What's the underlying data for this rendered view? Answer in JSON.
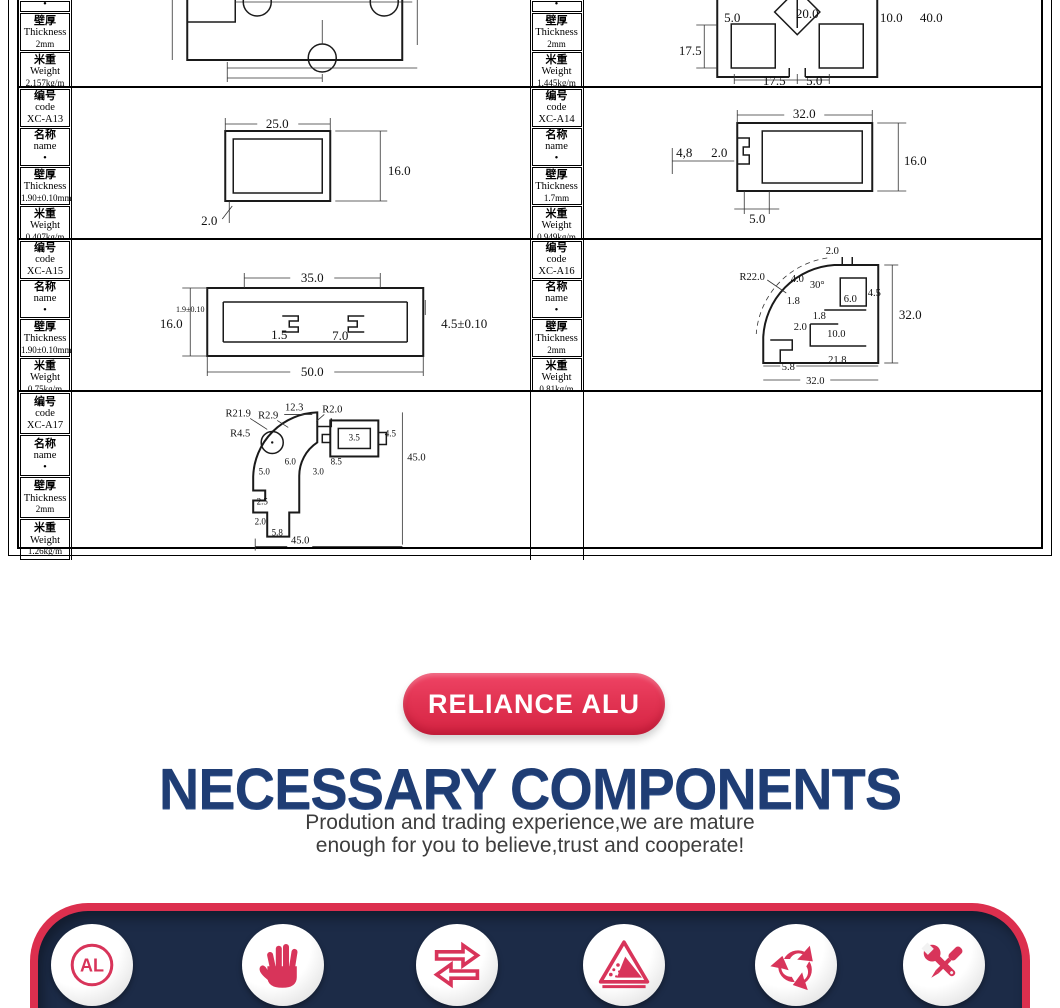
{
  "colors": {
    "crimson": "#d8345a",
    "navy": "#1c2b47",
    "red_border": "#dc2f4e",
    "heading_blue": "#1f3d74"
  },
  "table": {
    "header_labels": {
      "code_zh": "编号",
      "code_en": "code",
      "name_zh": "名称",
      "name_en": "name",
      "name_value": "•",
      "thk_zh": "壁厚",
      "thk_en": "Thickness",
      "wt_zh": "米重",
      "wt_en": "Weight"
    },
    "profiles": {
      "r1l": {
        "thickness": "2mm",
        "weight": "2.157kg/m"
      },
      "r1r": {
        "thickness": "2mm",
        "weight": "1.445kg/m",
        "dims": {
          "d1": "5.0",
          "d2": "20.0",
          "d3": "10.0",
          "d4": "40.0",
          "d5": "17.5",
          "d6": "17.5",
          "d7": "5.0"
        }
      },
      "a13": {
        "code": "XC-A13",
        "thickness": "1.90±0.10mm",
        "weight": "0.407kg/m",
        "dims": {
          "w": "25.0",
          "h": "16.0",
          "t": "2.0"
        }
      },
      "a14": {
        "code": "XC-A14",
        "thickness": "1.7mm",
        "weight": "0.949kg/m",
        "dims": {
          "w": "32.0",
          "h": "16.0",
          "g": "4,8",
          "t": "2.0",
          "b": "5.0"
        }
      },
      "a15": {
        "code": "XC-A15",
        "thickness": "1.90±0.10mm",
        "weight": "0.75kg/m",
        "dims": {
          "t": "35.0",
          "h": "16.0",
          "b": "50.0",
          "c1": "1.5",
          "c2": "7.0",
          "r": "4.5±0.10",
          "l": "1.9±0.10"
        }
      },
      "a16": {
        "code": "XC-A16",
        "thickness": "2mm",
        "weight": "0.81kg/m",
        "dims": {
          "r": "R22.0",
          "d1": "4.0",
          "a": "30°",
          "d2": "2.0",
          "d3": "4.5",
          "d4": "6.0",
          "d5": "1.8",
          "d6": "1.8",
          "d7": "2.0",
          "d8": "10.0",
          "h": "32.0",
          "b1": "5.8",
          "b2": "21.8",
          "w": "32.0"
        }
      },
      "a17": {
        "code": "XC-A17",
        "thickness": "2mm",
        "weight": "1.26kg/m",
        "dims": {
          "r1": "R21.9",
          "r2": "R2.9",
          "d1": "12.3",
          "r3": "R2.0",
          "r4": "R4.5",
          "d2": "3.5",
          "d3": "4.5",
          "d4": "6.0",
          "d5": "8.5",
          "d6": "3.0",
          "d7": "5.0",
          "h": "45.0",
          "d8": "2.5",
          "d9": "2.0",
          "b1": "5.8",
          "w": "45.0"
        }
      }
    }
  },
  "badge": {
    "label": "RELIANCE ALU"
  },
  "heading": {
    "title": "NECESSARY COMPONENTS",
    "subtitle_line1": "Prodution and trading experience,we are mature",
    "subtitle_line2": "enough for you to believe,trust and cooperate!"
  },
  "footer": {
    "al_label": "AL"
  }
}
